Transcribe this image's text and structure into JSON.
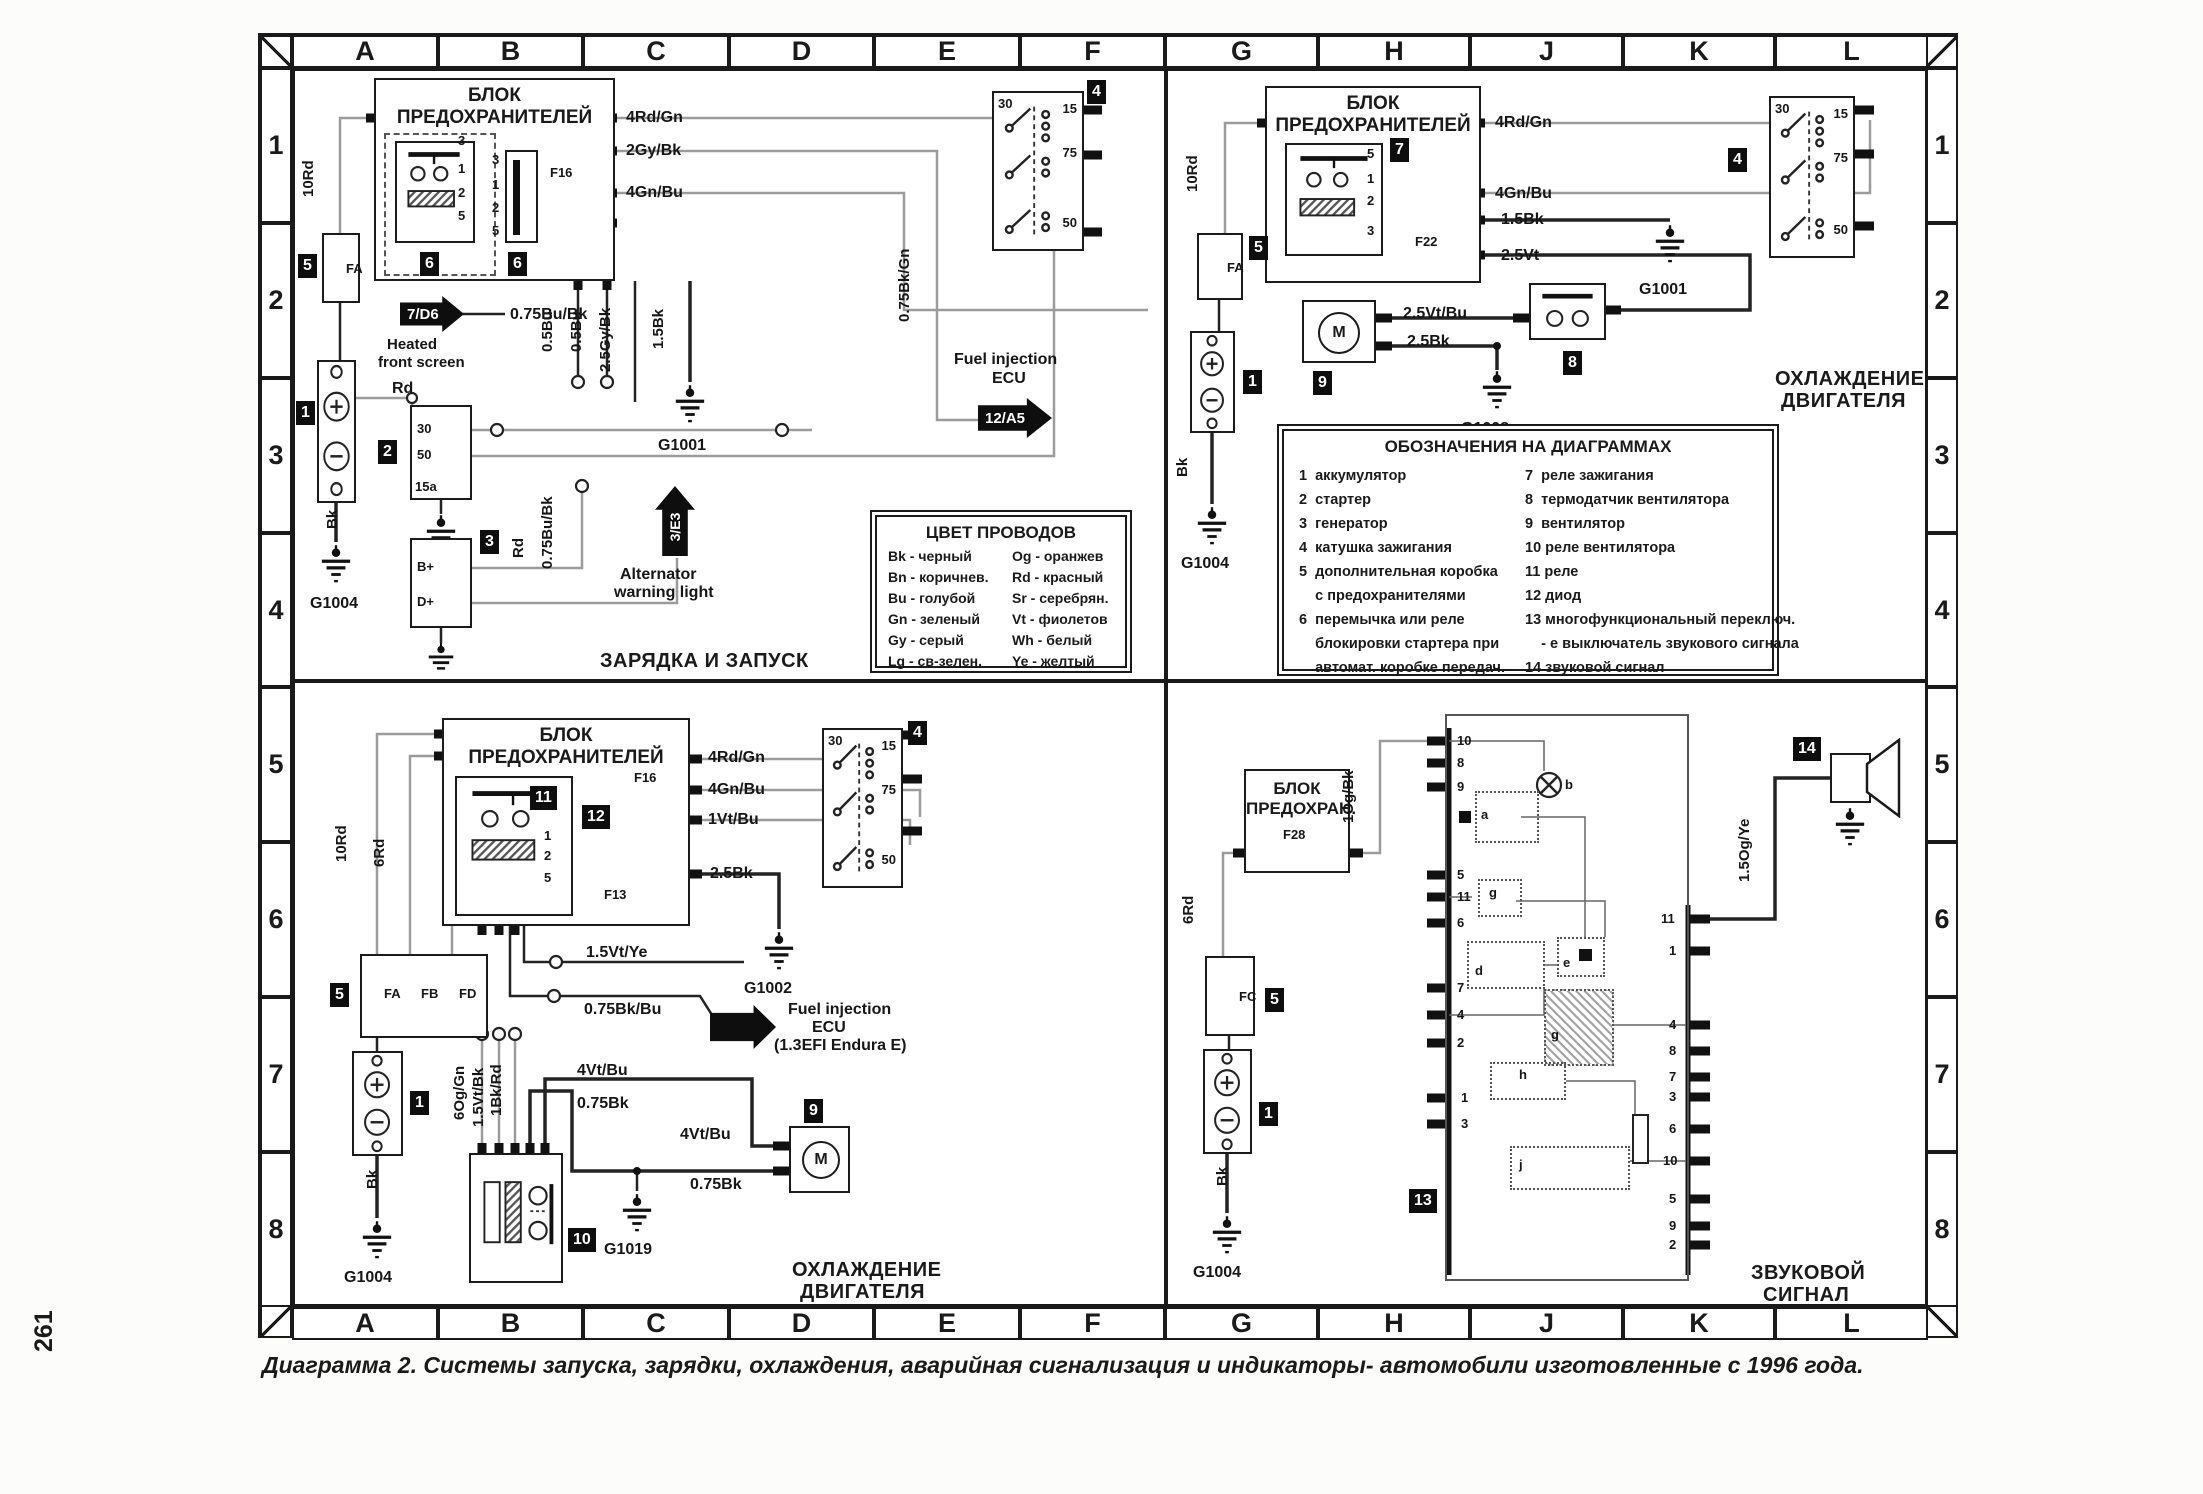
{
  "page": {
    "number": "261",
    "caption": "Диаграмма 2. Системы запуска, зарядки, охлаждения, аварийная сигнализация и индикаторы- автомобили изготовленные с 1996 года."
  },
  "symbols": {
    "motor": "M"
  },
  "grid": {
    "cols": [
      "A",
      "B",
      "C",
      "D",
      "E",
      "F",
      "G",
      "H",
      "J",
      "K",
      "L"
    ],
    "rows": [
      "1",
      "2",
      "3",
      "4",
      "5",
      "6",
      "7",
      "8"
    ]
  },
  "wire_colors_legend": {
    "title": "ЦВЕТ ПРОВОДОВ",
    "left": [
      "Bk - черный",
      "Bn - коричнев.",
      "Bu - голубой",
      "Gn - зеленый",
      "Gy - серый",
      "Lg - св-зелен."
    ],
    "right": [
      "Og - оранжев",
      "Rd - красный",
      "Sr - серебрян.",
      "Vt - фиолетов",
      "Wh - белый",
      "Ye - желтый"
    ]
  },
  "designations_legend": {
    "title": "ОБОЗНАЧЕНИЯ НА ДИАГРАММАХ",
    "left": [
      "1  аккумулятор",
      "2  стартер",
      "3  генератор",
      "4  катушка зажигания",
      "5  дополнительная коробка",
      "    с предохранителями",
      "6  перемычка или реле",
      "    блокировки стартера при",
      "    автомат. коробке передач."
    ],
    "right": [
      "7  реле зажигания",
      "8  термодатчик вентилятора",
      "9  вентилятор",
      "10 реле вентилятора",
      "11 реле",
      "12 диод",
      "13 многофункциональный переключ.",
      "    - е выключатель звукового сигнала",
      "14 звуковой сигнал"
    ]
  },
  "q1": {
    "fusebox_title": "БЛОК ПРЕДОХРАНИТЕЛЕЙ",
    "section_title": "ЗАРЯДКА И ЗАПУСК",
    "labels": {
      "w1": "4Rd/Gn",
      "w2": "2Gy/Bk",
      "w3": "4Gn/Bu",
      "w4": "0.75Bu/Bk",
      "w5": "Rd",
      "w6": "10Rd",
      "w7": "Bk",
      "w8": "Rd",
      "w9": "0.75Bu/Bk",
      "w10": "0.5Bu",
      "w11": "0.5Bu",
      "w12": "2.5Gy/Bk",
      "w13": "1.5Bk",
      "w14": "0.75Bk/Gn"
    },
    "fuses": {
      "f16": "F16",
      "fa": "FA"
    },
    "relay_pins": [
      "3",
      "1",
      "2",
      "5"
    ],
    "conn_pins": [
      "3",
      "1",
      "2",
      "5"
    ],
    "starter_pins": [
      "30",
      "50",
      "15a"
    ],
    "alternator_pins": [
      "B+",
      "D+"
    ],
    "ignition_pins": [
      "30",
      "15",
      "75",
      "50"
    ],
    "grounds": {
      "g1004": "G1004",
      "g1001": "G1001"
    },
    "badges": {
      "battery": "1",
      "starter": "2",
      "alternator": "3",
      "ignition": "4",
      "aux": "5",
      "relay": "6",
      "conn": "6"
    },
    "arrows": {
      "heated_ref": "7/D6",
      "heated_cap1": "Heated",
      "heated_cap2": "front screen",
      "alt_ref": "3/Е3",
      "alt_cap1": "Alternator",
      "alt_cap2": "warning light",
      "ecu_ref": "12/A5",
      "ecu_cap1": "Fuel injection",
      "ecu_cap2": "ECU"
    }
  },
  "q2": {
    "fusebox_title": "БЛОК ПРЕДОХРАНИТЕЛЕЙ",
    "section_title1": "ОХЛАЖДЕНИЕ",
    "section_title2": "ДВИГАТЕЛЯ",
    "labels": {
      "w1": "4Rd/Gn",
      "w2": "4Gn/Bu",
      "w3": "1.5Bk",
      "w4": "2.5Vt",
      "w5": "2.5Vt/Bu",
      "w6": "2.5Bk",
      "w7": "10Rd",
      "w8": "Bk"
    },
    "fuses": {
      "f22": "F22",
      "fa": "FA"
    },
    "relay_pins": [
      "5",
      "1",
      "2",
      "3"
    ],
    "ignition_pins": [
      "30",
      "15",
      "75",
      "50"
    ],
    "grounds": {
      "g1001": "G1001",
      "g1008": "G1008",
      "g1004": "G1004"
    },
    "badges": {
      "battery": "1",
      "aux": "5",
      "relay": "7",
      "thermo": "8",
      "fan": "9",
      "ignition": "4"
    }
  },
  "q3": {
    "fusebox_title": "БЛОК ПРЕДОХРАНИТЕЛЕЙ",
    "section_title1": "ОХЛАЖДЕНИЕ",
    "section_title2": "ДВИГАТЕЛЯ",
    "labels": {
      "w1": "4Rd/Gn",
      "w2": "4Gn/Bu",
      "w3": "1Vt/Bu",
      "w4": "2.5Bk",
      "w5": "1.5Vt/Ye",
      "w6": "0.75Bk/Bu",
      "w7": "10Rd",
      "w8": "6Rd",
      "w9": "6Og/Gn",
      "w10": "1.5Vt/Bk",
      "w11": "1Bk/Rd",
      "w12": "4Vt/Bu",
      "w13": "0.75Bk",
      "w14": "4Vt/Bu",
      "w15": "0.75Bk",
      "w16": "Bk"
    },
    "fuses": {
      "f16": "F16",
      "f13": "F13",
      "fa": "FA",
      "fb": "FB",
      "fd": "FD"
    },
    "relay_pins": [
      "3",
      "1",
      "2",
      "5"
    ],
    "ignition_pins": [
      "30",
      "15",
      "75",
      "50"
    ],
    "grounds": {
      "g1002": "G1002",
      "g1019": "G1019",
      "g1004": "G1004"
    },
    "badges": {
      "battery": "1",
      "aux": "5",
      "relay": "11",
      "diode": "12",
      "fanrelay": "10",
      "fan": "9",
      "ignition": "4"
    },
    "ecu": {
      "cap1": "Fuel injection",
      "cap2": "ECU",
      "cap3": "(1.3EFI Endura E)"
    }
  },
  "q4": {
    "fusebox_title1": "БЛОК",
    "fusebox_title2": "ПРЕДОХРАН.",
    "section_title1": "ЗВУКОВОЙ",
    "section_title2": "СИГНАЛ",
    "labels": {
      "w1": "6Rd",
      "w2": "1Og/Bk",
      "w3": "1.5Og/Ye",
      "w4": "Bk"
    },
    "fuses": {
      "f28": "F28",
      "fc": "FC"
    },
    "grounds": {
      "g1004": "G1004"
    },
    "badges": {
      "battery": "1",
      "aux": "5",
      "mfs": "13",
      "horn": "14"
    },
    "left_pins": [
      "10",
      "8",
      "9",
      "5",
      "11",
      "6",
      "7",
      "4",
      "2",
      "1",
      "3"
    ],
    "right_pins": [
      "11",
      "1",
      "4",
      "8",
      "7",
      "3",
      "6",
      "10",
      "5",
      "9",
      "2"
    ],
    "letters": {
      "a": "a",
      "b": "b",
      "g1": "g",
      "d": "d",
      "e": "e",
      "g2": "g",
      "h": "h",
      "j": "j"
    }
  }
}
